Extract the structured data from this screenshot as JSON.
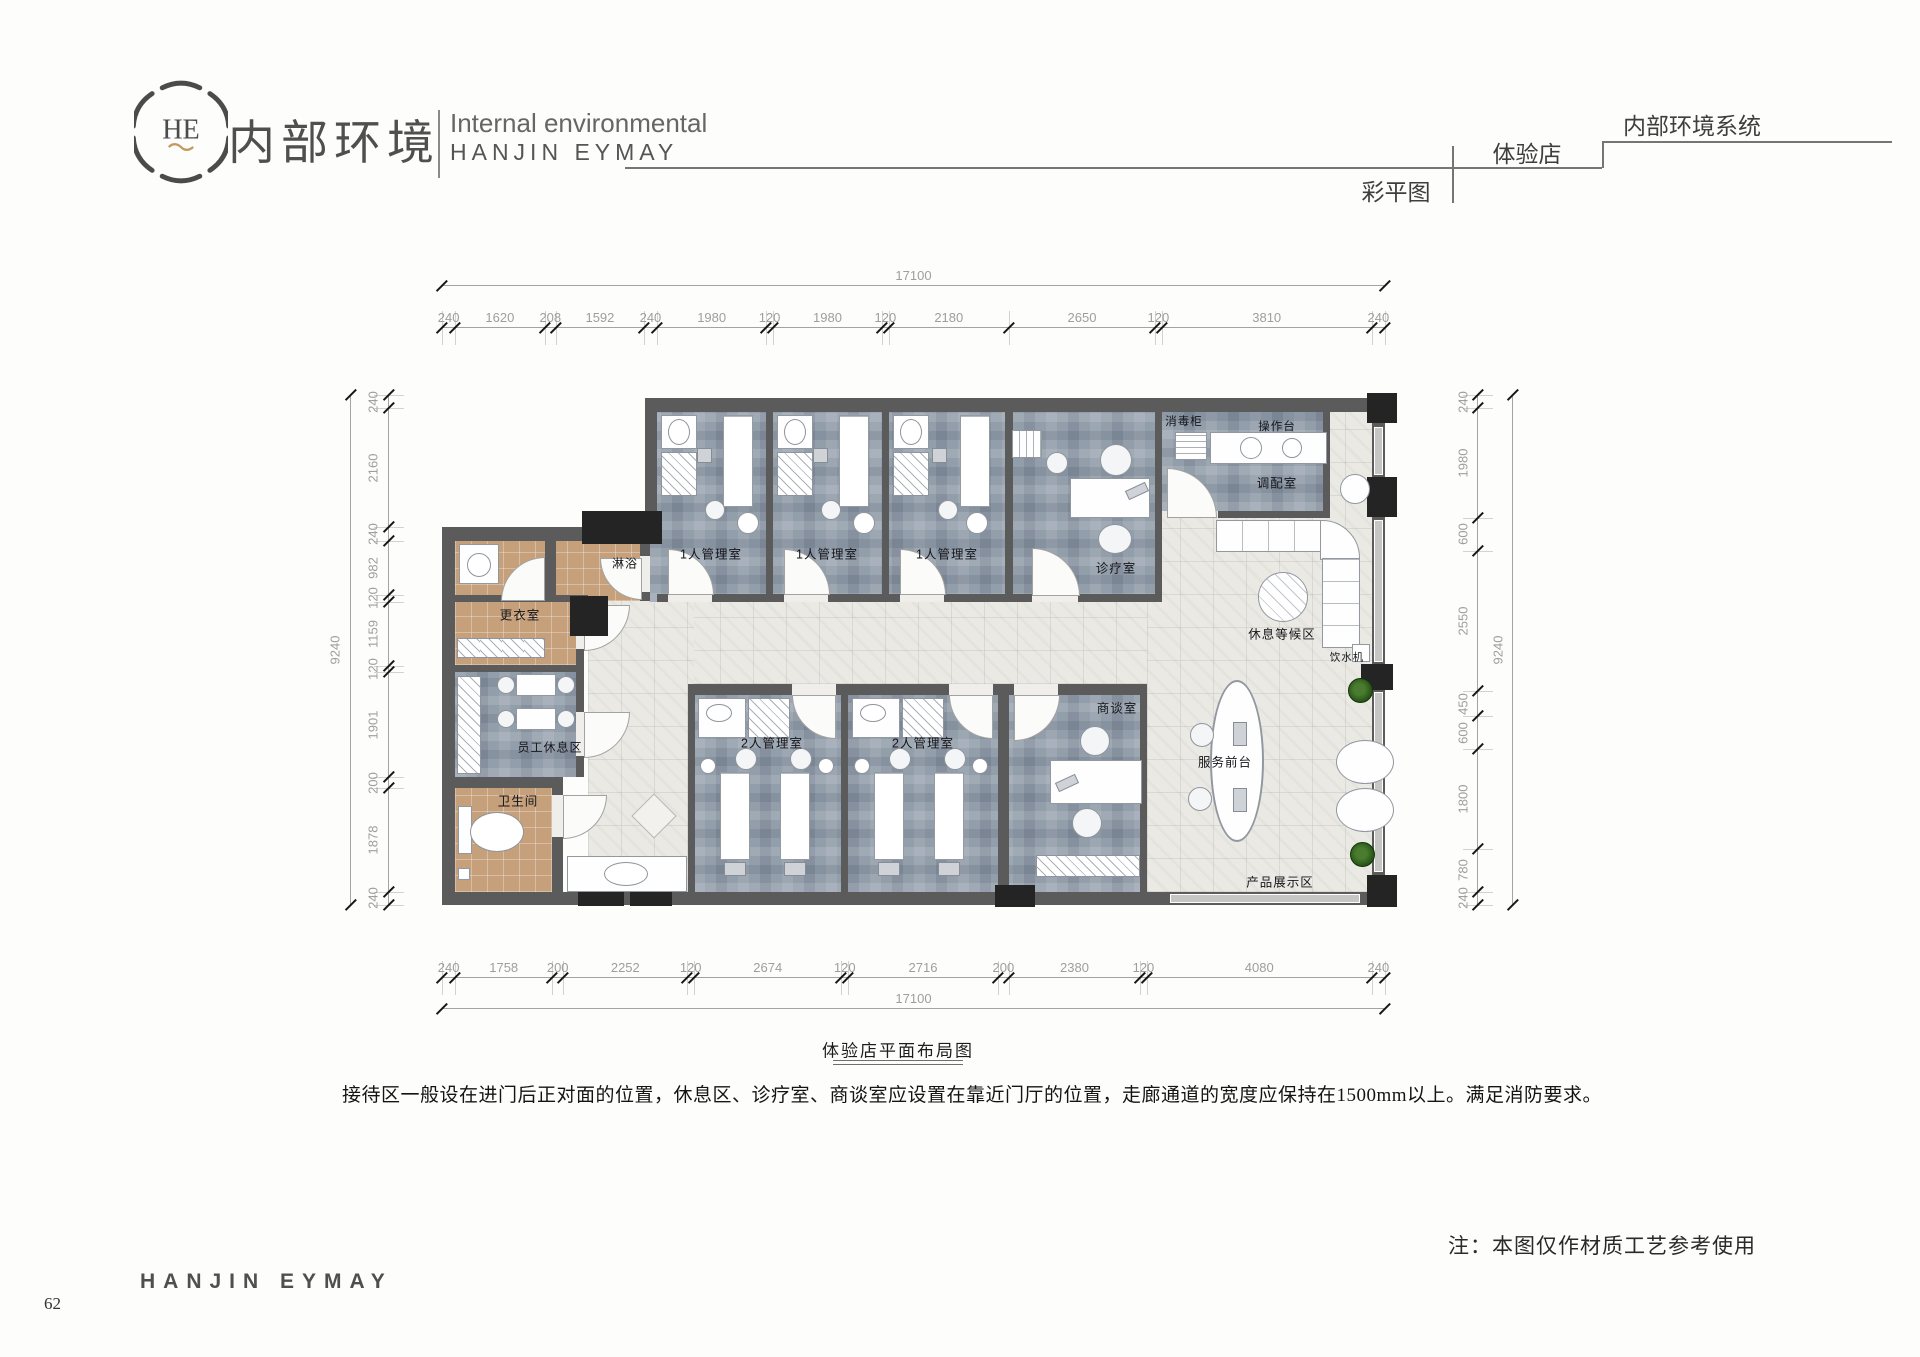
{
  "header": {
    "logo_monogram": "HE",
    "brand_cn": "内部环境",
    "brand_en_line1": "Internal environmental",
    "brand_en_line2": "HANJIN EYMAY",
    "tab_store": "体验店",
    "tab_system": "内部环境系统",
    "tab_plan": "彩平图"
  },
  "plan": {
    "title": "体验店平面布局图",
    "description": "接待区一般设在进门后正对面的位置，休息区、诊疗室、商谈室应设置在靠近门厅的位置，走廊通道的宽度应保持在1500mm以上。满足消防要求。",
    "note": "注：本图仅作材质工艺参考使用",
    "rooms": {
      "mgmt1": "1人管理室",
      "mgmt2": "2人管理室",
      "treatment": "诊疗室",
      "consult": "商谈室",
      "dispensing": "调配室",
      "disinfect_cabinet": "消毒柜",
      "operation_counter": "操作台",
      "waiting": "休息等候区",
      "water_dispenser": "饮水机",
      "reception": "服务前台",
      "product_display": "产品展示区",
      "shower": "淋浴",
      "changing": "更衣室",
      "staff_rest": "员工休息区",
      "toilet": "卫生间"
    }
  },
  "dims": {
    "top": [
      240,
      1620,
      208,
      1592,
      240,
      1980,
      120,
      1980,
      120,
      2180,
      2650,
      120,
      3810,
      240
    ],
    "bottom": [
      240,
      1758,
      200,
      2252,
      120,
      2674,
      120,
      2716,
      200,
      2380,
      120,
      4080,
      240
    ],
    "left": [
      240,
      2160,
      240,
      982,
      120,
      1159,
      120,
      1901,
      200,
      1878,
      240
    ],
    "right": [
      240,
      1980,
      600,
      2550,
      450,
      600,
      1800,
      780,
      240
    ],
    "top_total": [
      17100
    ],
    "bottom_total": [
      17100
    ],
    "left_total": [
      9240
    ],
    "right_total": [
      9240
    ]
  },
  "footer": {
    "brand": "HANJIN EYMAY",
    "page": "62"
  },
  "colors": {
    "wall": "#5b5b5b",
    "column": "#242424",
    "room_floor": "#939eab",
    "warm_floor": "#c5a07b",
    "corridor_floor": "#eae9e4",
    "accent_gold": "#c39a5e"
  }
}
